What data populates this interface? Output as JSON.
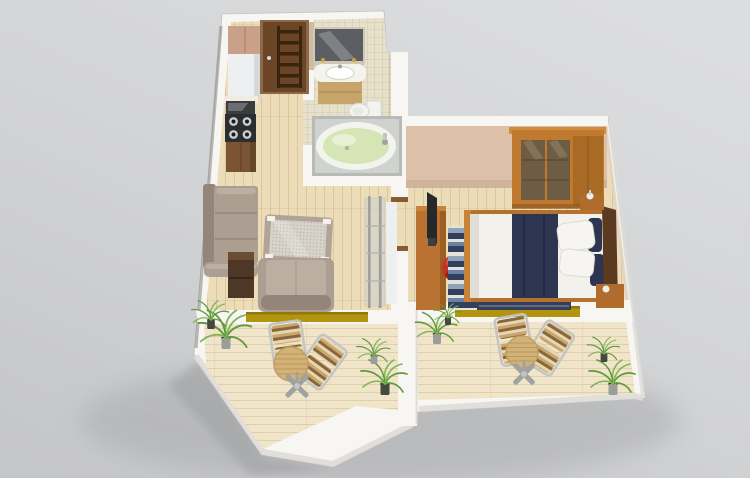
{
  "scene": {
    "title": "Isometric 3D rendering of a one-bedroom apartment floor plan with two terraces",
    "render_style": "3d-floorplan"
  },
  "colors": {
    "bg_top": "#dadbdd",
    "bg_bottom": "#c6c7c9",
    "shadow": "#a8a9ab",
    "wall": "#f7f6f3",
    "wall_shade": "#dedcd8",
    "wall_dark": "#8f8e8b",
    "wood": "#ecdcb8",
    "balcony_wood": "#f0e5c8",
    "tile": "#e7e0ca",
    "tile_dark": "#ddd5bd",
    "bedroom_wall": "#dcc1a8",
    "bedroom_wall_dark": "#c8ab8f",
    "door": "#6b4526",
    "door_frame": "#8a6a4a",
    "door_rung": "#38240f",
    "cab_upper": "#c9a088",
    "fridge": "#edeff0",
    "fridge_shade": "#d6d9da",
    "oven": "#3a3d40",
    "cooktop": "#2c2d2f",
    "burner_ring": "#c9ced2",
    "burner_center": "#1b1c1e",
    "cab_wood": "#7b5433",
    "counter": "#f0ece2",
    "mirror": "#5b5e63",
    "shelf_tan": "#cfc7b0",
    "vanity": "#c7a469",
    "porcelain": "#f4f4ef",
    "porcelain_line": "#d9d6ca",
    "tub_platform": "#b7bab7",
    "tub_platform_top": "#cfd2cf",
    "tub_water": "#d5e5b5",
    "sofa": "#ac9e91",
    "sofa_dark": "#93857a",
    "sofa_light": "#bcaea1",
    "ottoman_border": "#b1a496",
    "ottoman_glass": "#d7d3cb",
    "pad_white": "#f4f3f0",
    "side_table": "#4e3726",
    "side_table_top": "#6b4d33",
    "shelf_glass": "#ccd0ce",
    "chrome": "#9da09e",
    "panel_white": "#eef0ef",
    "wardrobe": "#c07a30",
    "wardrobe_crown": "#d28a3c",
    "wardrobe_side": "#a96a26",
    "wardrobe_glass": "#6e5c44",
    "wardrobe_glass_hi": "#8a775c",
    "desk": "#b97231",
    "tv": "#26282a",
    "red_chair": "#c23522",
    "red_chair_dark": "#8c2115",
    "bed_frame": "#b5722f",
    "bed_frame_hi": "#c98338",
    "mattress": "#f2f1ec",
    "mattress_shade": "#e0ded6",
    "navy": "#2e3550",
    "navy_dark": "#232944",
    "pillow_white": "#f6f5f1",
    "headboard": "#5b3a20",
    "nightstand": "#b06c2c",
    "rug_light": "#e3e2db",
    "rug_blue": "#8fa2b6",
    "rug_navy": "#32405e",
    "rug_mid": "#6b82a2",
    "runner_navy": "#353f5a",
    "runner_line": "#aebacb",
    "threshold": "#b2940e",
    "threshold_dark": "#8f7708",
    "table_wood": "#d3b277",
    "table_wood_line": "#b28e52",
    "metal": "#c3c5c3",
    "metal_dark": "#9fa2a0",
    "stripe_a": "#c9a870",
    "stripe_b": "#8a663c",
    "stripe_c": "#e6d6b2",
    "leaf": "#5f9a3e",
    "leaf_light": "#7fb457",
    "pot_dark": "#45483f",
    "pot_silver": "#9b9d9b",
    "soil": "#2e3028"
  },
  "rooms": [
    {
      "id": "kitchen",
      "furniture": [
        "upper-cabinet",
        "refrigerator",
        "oven",
        "gas-cooktop",
        "base-cabinet"
      ]
    },
    {
      "id": "hallway",
      "furniture": [
        "entry-door"
      ]
    },
    {
      "id": "bathroom",
      "furniture": [
        "mirror",
        "washbasin-vanity",
        "toilet",
        "bathtub"
      ]
    },
    {
      "id": "living-room",
      "furniture": [
        "corner-sofa",
        "side-table",
        "coffee-table",
        "armchair",
        "glass-shelf-unit"
      ]
    },
    {
      "id": "bedroom",
      "furniture": [
        "wardrobe",
        "desk",
        "tv",
        "swivel-chair",
        "striped-rug",
        "runner-rug",
        "double-bed",
        "nightstand",
        "dresser"
      ]
    },
    {
      "id": "terrace-left",
      "furniture": [
        "bistro-chair",
        "bistro-chair",
        "bistro-table",
        "potted-palm",
        "potted-palm"
      ]
    },
    {
      "id": "terrace-right",
      "furniture": [
        "bistro-chair",
        "bistro-chair",
        "bistro-table",
        "potted-palm",
        "potted-palm"
      ]
    }
  ]
}
